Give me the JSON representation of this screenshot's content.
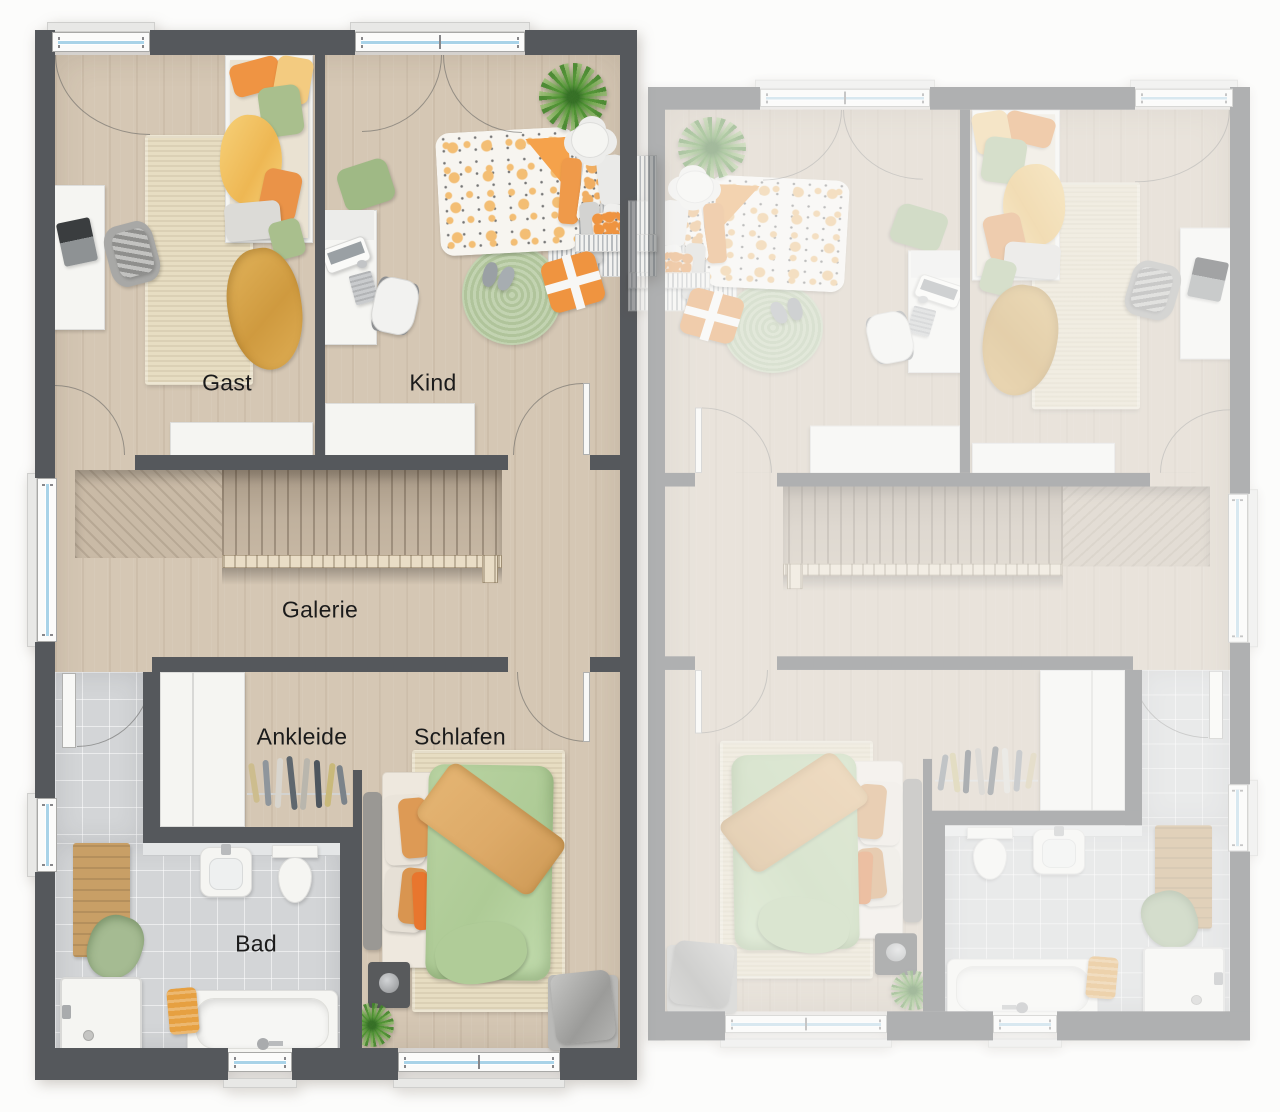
{
  "canvas": {
    "width": 1280,
    "height": 1112,
    "background": "#fcfcfb"
  },
  "rooms": {
    "gast": {
      "label": "Gast",
      "furniture": [
        "single-bed",
        "area-rug",
        "desk",
        "laptop",
        "chair",
        "blanket",
        "sideboard"
      ]
    },
    "kind": {
      "label": "Kind",
      "furniture": [
        "single-bed",
        "round-rug",
        "desk",
        "computer",
        "chair",
        "plant",
        "side-table",
        "floor-pillow",
        "slippers",
        "gift-pillow",
        "sideboard"
      ]
    },
    "galerie": {
      "label": "Galerie",
      "furniture": [
        "staircase",
        "railing"
      ]
    },
    "ankleide": {
      "label": "Ankleide",
      "furniture": [
        "wardrobe",
        "clothes-rail"
      ]
    },
    "schlafen": {
      "label": "Schlafen",
      "furniture": [
        "double-bed",
        "area-rug",
        "nightstand",
        "plant",
        "bench"
      ]
    },
    "bad": {
      "label": "Bad",
      "furniture": [
        "shower",
        "bathtub",
        "washbasin",
        "toilet",
        "bath-mat",
        "towel"
      ]
    }
  },
  "units": {
    "left": {
      "name": "unit-left",
      "labels_visible": true
    },
    "right": {
      "name": "unit-right-mirrored",
      "labels_visible": false,
      "appearance": "faded mirror copy of left unit"
    }
  },
  "windows": {
    "top": 2,
    "left": 2,
    "bottom": 2,
    "per_unit": 6
  },
  "colors": {
    "pageBg": "#fcfcfb",
    "wall": "#55585c",
    "floor": "#d5c7b4",
    "floorStair": "#c9baa6",
    "tile": "#d3d5d7",
    "rugCream": "#e7ddc2",
    "rugGreen": "#b7cba2",
    "duvetGreen": "#b9d3a2",
    "throwTan": "#ddaa68",
    "orange": "#ef9440",
    "orangeDeep": "#e8762e",
    "yellow": "#f3c465",
    "mustard": "#d5a04a",
    "sage": "#a9bf8d",
    "windowBlue": "#a9d3e8",
    "plantGreen": "#63a546",
    "railWood": "#e9ddc6",
    "matWood": "#c89f66",
    "labelInk": "#1b1b1b",
    "furnWhite": "#f5f5f2",
    "grayFurn": "#9fa1a0"
  }
}
